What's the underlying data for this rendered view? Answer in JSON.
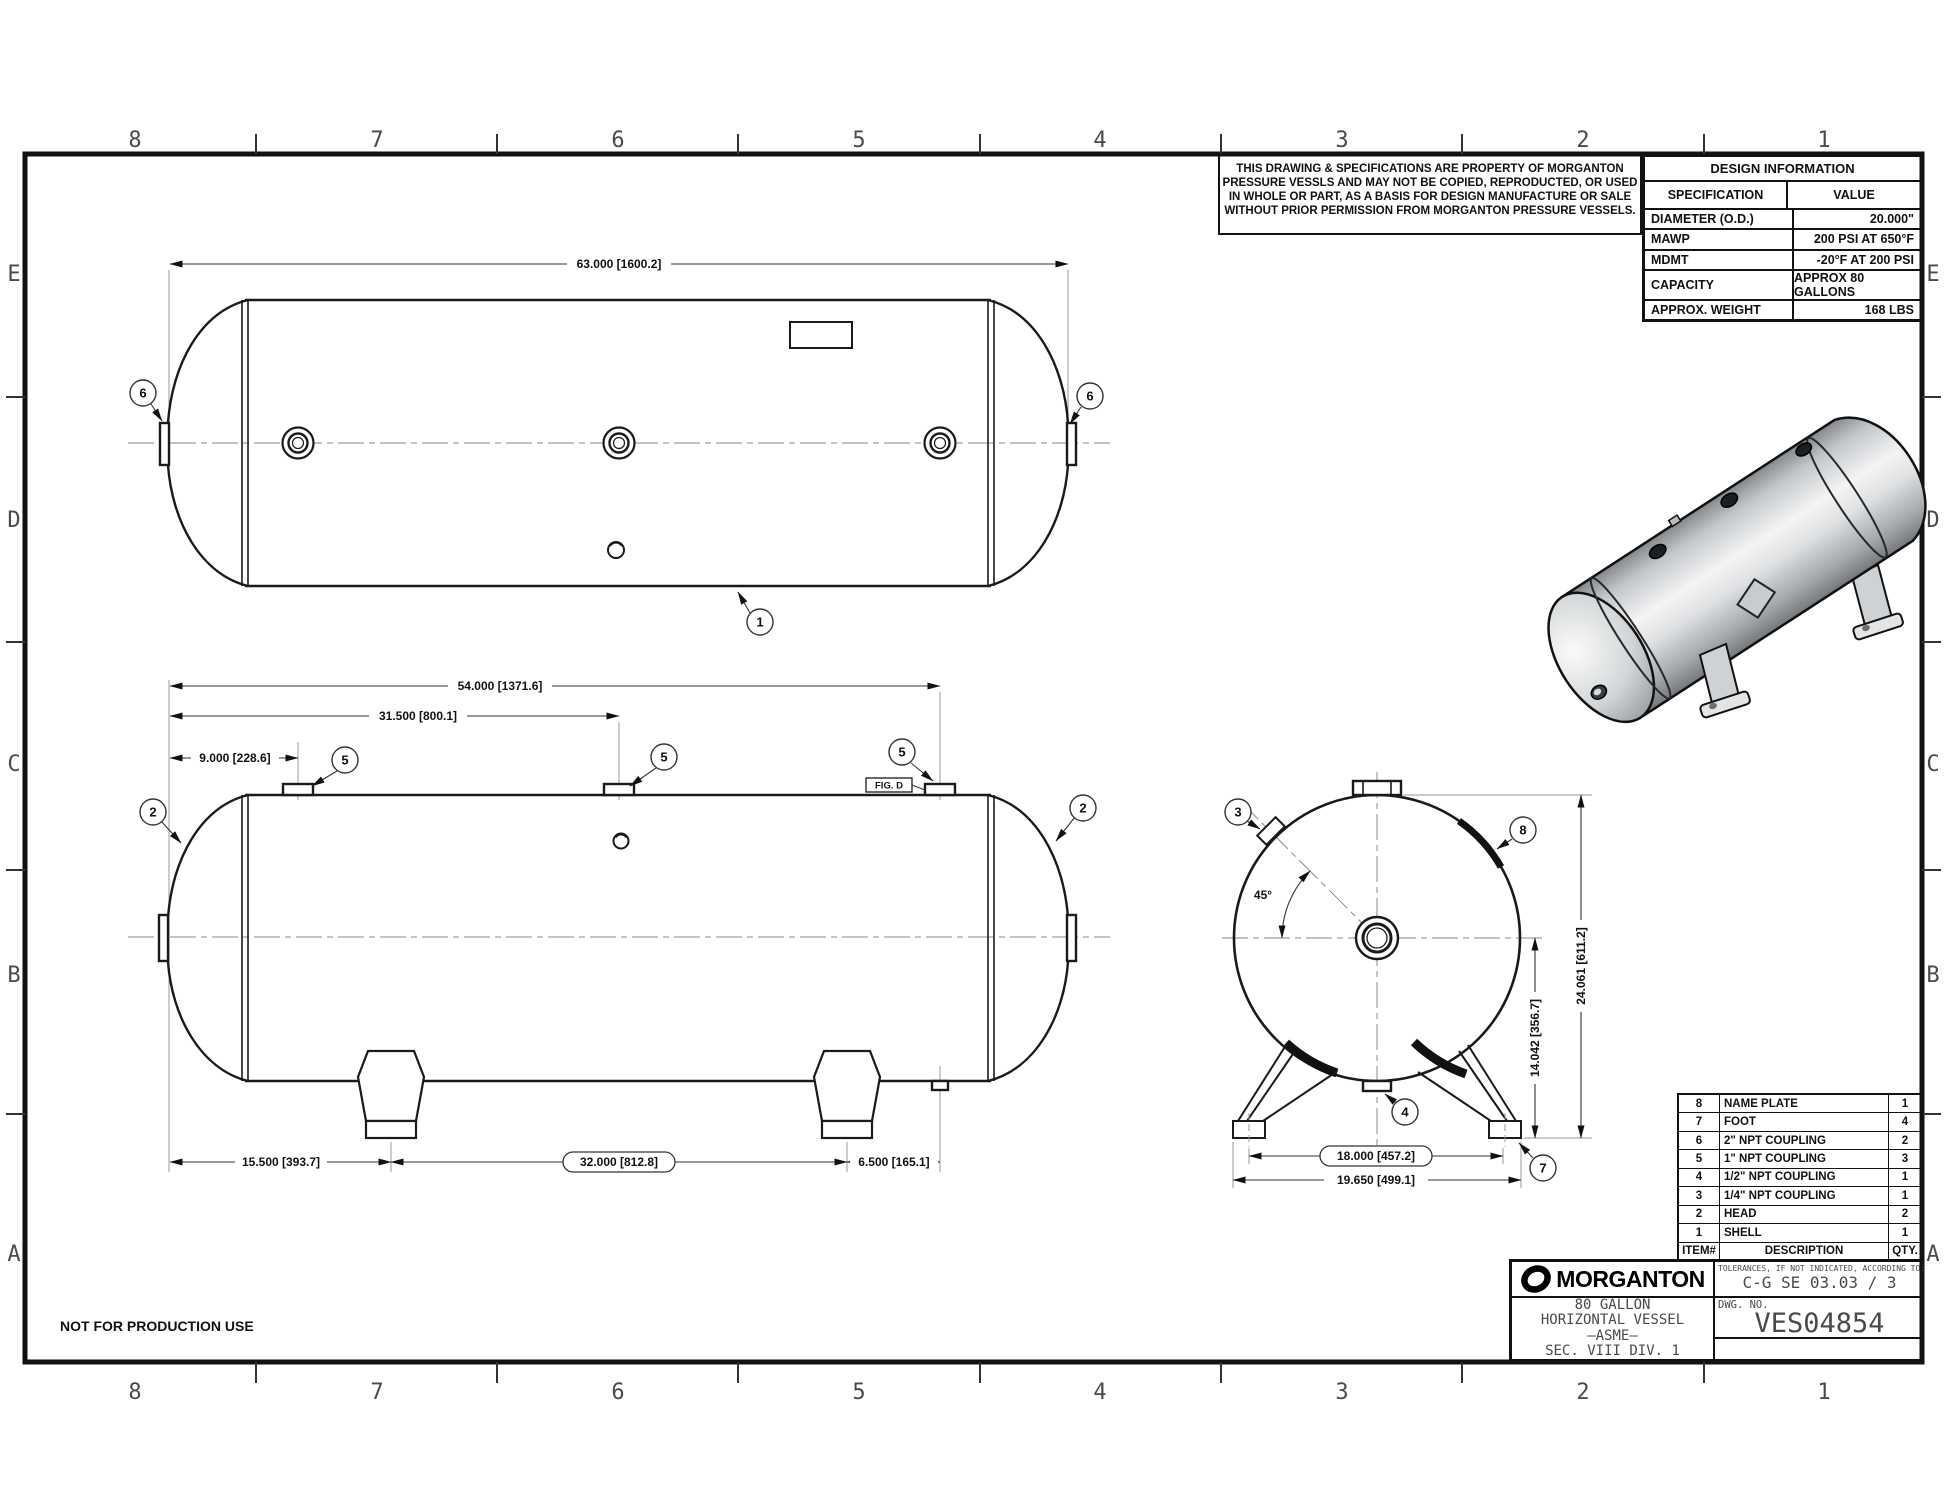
{
  "sheet": {
    "grid_cols": [
      "8",
      "7",
      "6",
      "5",
      "4",
      "3",
      "2",
      "1"
    ],
    "grid_rows": [
      "E",
      "D",
      "C",
      "B",
      "A"
    ],
    "footer_note": "NOT FOR PRODUCTION USE"
  },
  "disclaimer": {
    "lines": [
      "THIS DRAWING & SPECIFICATIONS ARE PROPERTY OF MORGANTON",
      "PRESSURE VESSLS AND MAY NOT BE COPIED, REPRODUCTED,  OR USED",
      "IN WHOLE OR PART, AS A BASIS FOR DESIGN MANUFACTURE OR SALE",
      "WITHOUT PRIOR PERMISSION FROM MORGANTON PRESSURE VESSELS."
    ]
  },
  "design_info": {
    "title": "DESIGN INFORMATION",
    "col_spec": "SPECIFICATION",
    "col_value": "VALUE",
    "rows": [
      {
        "spec": "DIAMETER (O.D.)",
        "value": "20.000\""
      },
      {
        "spec": "MAWP",
        "value": "200 PSI AT 650°F"
      },
      {
        "spec": "MDMT",
        "value": "-20°F AT 200 PSI"
      },
      {
        "spec": "CAPACITY",
        "value": "APPROX 80 GALLONS"
      },
      {
        "spec": "APPROX. WEIGHT",
        "value": "168 LBS"
      }
    ]
  },
  "bom": {
    "header": {
      "item": "ITEM#",
      "desc": "DESCRIPTION",
      "qty": "QTY."
    },
    "rows": [
      {
        "item": "8",
        "desc": "NAME PLATE",
        "qty": "1"
      },
      {
        "item": "7",
        "desc": "FOOT",
        "qty": "4"
      },
      {
        "item": "6",
        "desc": "2\" NPT COUPLING",
        "qty": "2"
      },
      {
        "item": "5",
        "desc": "1\" NPT COUPLING",
        "qty": "3"
      },
      {
        "item": "4",
        "desc": "1/2\" NPT COUPLING",
        "qty": "1"
      },
      {
        "item": "3",
        "desc": "1/4\" NPT COUPLING",
        "qty": "1"
      },
      {
        "item": "2",
        "desc": "HEAD",
        "qty": "2"
      },
      {
        "item": "1",
        "desc": "SHELL",
        "qty": "1"
      }
    ]
  },
  "title_block": {
    "brand": "MORGANTON",
    "title_lines": [
      "80 GALLON",
      "HORIZONTAL VESSEL",
      "–ASME–",
      "SEC. VIII DIV. 1"
    ],
    "tol_label": "TOLERANCES, IF NOT INDICATED, ACCORDING TO:",
    "tol_value": "C-G SE 03.03 / 3",
    "dwg_label": "DWG. NO.",
    "dwg_no": "VES04854"
  },
  "dims": {
    "overall_length": "63.000 [1600.2]",
    "coupling_far": "54.000 [1371.6]",
    "coupling_mid": "31.500 [800.1]",
    "coupling_first": "9.000 [228.6]",
    "leg_offset": "15.500 [393.7]",
    "leg_spacing": "32.000 [812.8]",
    "drain_offset": "6.500 [165.1]",
    "foot_centers": "18.000 [457.2]",
    "foot_overall": "19.650 [499.1]",
    "height_center": "14.042 [356.7]",
    "height_overall": "24.061 [611.2]",
    "angle": "45°"
  },
  "balloons": {
    "b1": "1",
    "b2": "2",
    "b3": "3",
    "b4": "4",
    "b5": "5",
    "b6": "6",
    "b7": "7",
    "b8": "8"
  },
  "labels": {
    "fig_d": "FIG. D"
  }
}
